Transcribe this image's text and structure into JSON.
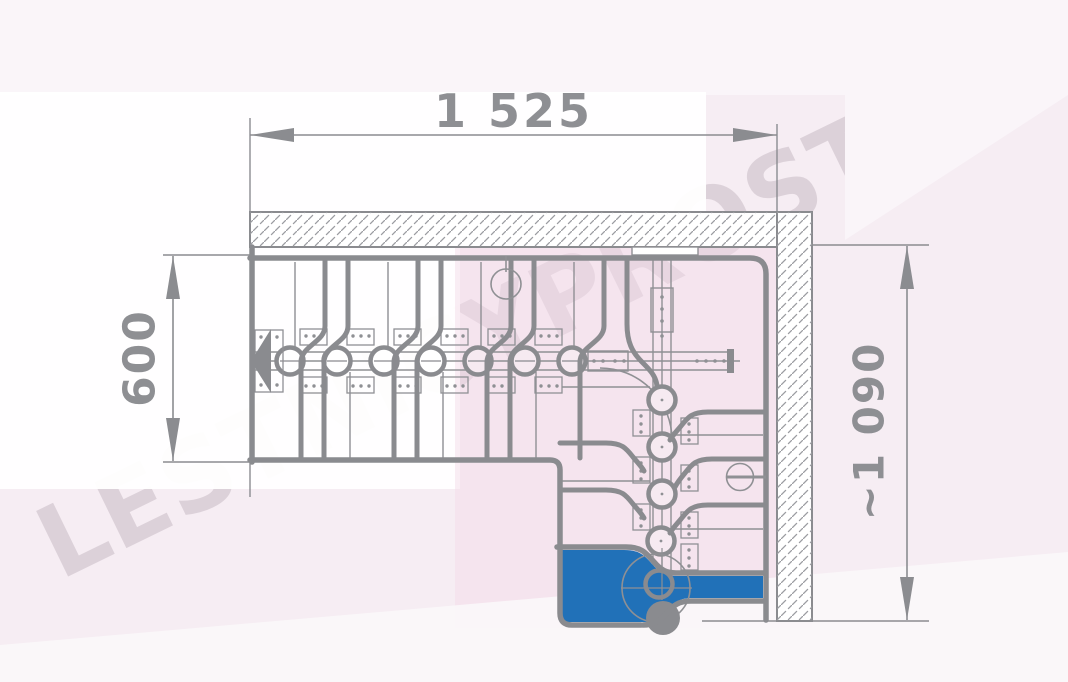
{
  "watermark": {
    "text": "LESTNICYPROSTO.RU"
  },
  "dimensions": {
    "top": {
      "label": "1 525"
    },
    "left": {
      "label": "600"
    },
    "right": {
      "label": "~1 090"
    }
  },
  "drawing": {
    "kind": "staircase floor plan, L-shaped modular stair with turn",
    "highlight": "bottom entry step highlighted in blue"
  },
  "colors": {
    "line_gray": "#8a8b8f",
    "dimension_text": "#8e8f93",
    "highlight_blue": "#2171b8",
    "background_pink": "#f6edf3",
    "watermark": "rgba(147,131,143,0.26)"
  }
}
